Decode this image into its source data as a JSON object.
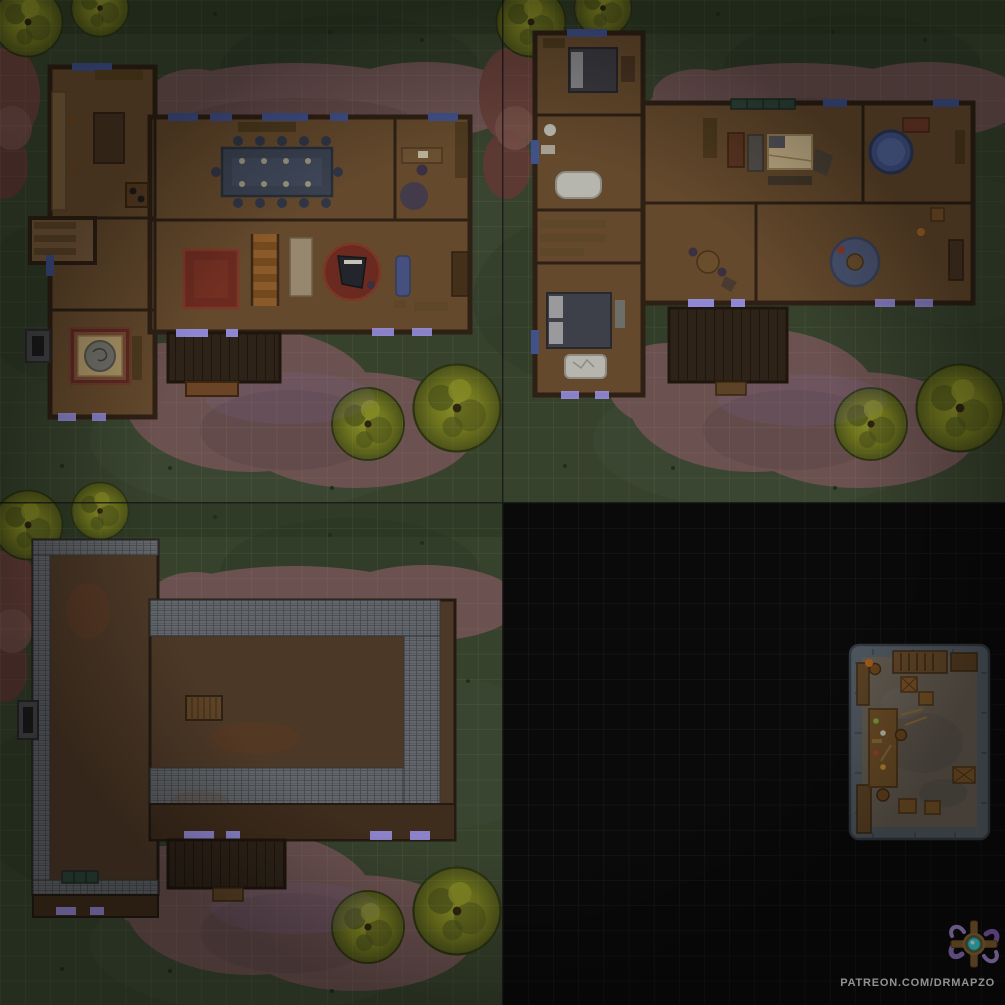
{
  "watermark": {
    "text": "PATREON.COM/DRMAPZO"
  },
  "logo": {
    "icon": "drmapzo-tentacle-compass-emblem"
  },
  "grid": {
    "cells_per_quadrant": 20,
    "cell_px": 25,
    "quadrants": 4
  },
  "palette": {
    "backdrop": "#0a0a0a",
    "grass": "#37422d",
    "grass_dark": "#2c3726",
    "grass_light": "#41503a",
    "grid_line_grass": "rgba(200,214,160,0.12)",
    "grid_line_dark": "#1c1c1c",
    "path": "#6b5150",
    "path_dark": "#5d4645",
    "rock": "#67403a",
    "tree": "#767b20",
    "wall": "#2e2015",
    "floor": "#64492c",
    "floor_light": "#75583a",
    "porch_wood": "#2e2318",
    "glass": "#41518a",
    "glass_glow": "#9a92e8",
    "table_slate": "#3a4150",
    "rug_red": "#6b2a20",
    "stairs": "#8a5a28",
    "roof": "#4c3826",
    "shingle": "#63666a",
    "cellar_wall": "#525a62",
    "cellar_floor": "#655d52",
    "crate": "#7a5428",
    "bed_tan": "#c4b088",
    "white_fabric": "#b6b6ae",
    "rug_blue": "#4a5572",
    "tub_water": "#44558a",
    "bronze": "#7a5a2c",
    "teal": "#3fc8c8",
    "purple": "#8a6cb8",
    "watermark_text": "#d6d6d6"
  }
}
